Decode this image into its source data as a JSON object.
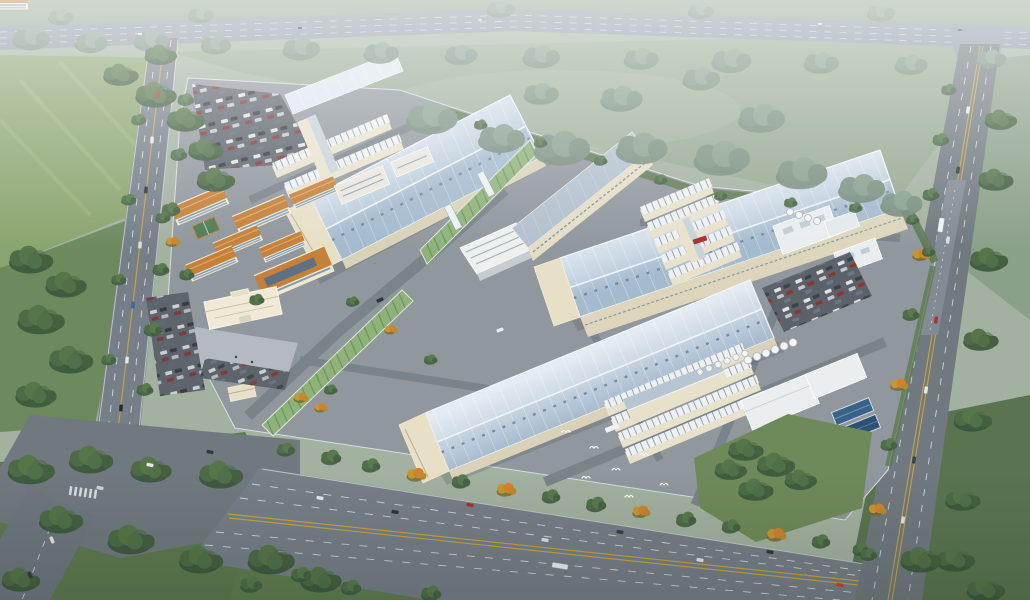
{
  "scene": {
    "title": "Industrial Park Campus — Aerial Rendering",
    "description": "Hazy bird's-eye photorealistic rendering of a large industrial park: three large blue-grey ridged factory halls with cream entrance annexes, clusters of white workshop rows, terracotta-roofed dormitory blocks with a canteen and basketball court, an administration building with forecourt plaza and gatehouse, a utility plant with silos and blue water basins, car parks full of vehicles, tree-lined perimeter roads, green fields and forest belts, and birds flying near the south boulevard.",
    "style": "photorealistic 3D render, hazy daylight, elevated oblique view",
    "counts": {
      "large_factory_halls": 3,
      "small_roof_hall": 1,
      "dormitory_blocks": 6,
      "canteen": 1,
      "office_building": 1,
      "midrise_building": 1,
      "admin_building": 1,
      "workshop_row_clusters": 3,
      "conveyor_galleries": 2,
      "overpass_bridges": 2,
      "utility_plant_blocks": 3,
      "water_basins": 2,
      "silos": 14,
      "parking_lots": 3,
      "gatehouse": 1,
      "billboard": 1,
      "basketball_court": 1,
      "birds": 7
    },
    "roads": [
      "north highway",
      "west avenue",
      "south boulevard",
      "east road",
      "southwest road"
    ],
    "landscape": [
      "forest belts",
      "hazy green fields",
      "mown bright field",
      "campus lawns",
      "autumn trees"
    ]
  },
  "palette": {
    "haze": "#ffffff",
    "field_hazy": "#96a992",
    "field_bright": "#8aa46f",
    "grass_dark": "#5e7a50",
    "lawn": "#6f8a5a",
    "tree_green": "#4e6e48",
    "tree_hazy": "#7d9383",
    "tree_autumn": "#c9962f",
    "highway": "#8c98a2",
    "road": "#767f88",
    "intersection": "#70797f",
    "road_marking_white": "#eef2f5",
    "road_marking_yellow": "#cfa83d",
    "campus_ground": "#90979d",
    "factory_roof_light": "#dde7f0",
    "factory_roof_dark": "#a8bdd0",
    "factory_wall": "#e7e0c6",
    "factory_wall_shade": "#d9d2b9",
    "dorm_wall": "#f1e8d0",
    "dorm_roof": "#c5803a",
    "window_band": "#7c99b5",
    "green_glass": "#8fb27b",
    "office_white": "#edf0ee",
    "midrise_roof": "#b2c0cd",
    "container_white": "#eef1f3",
    "parking_asphalt": "#5b6269",
    "plaza": "#b5bac0",
    "admin_wall": "#efe9d6",
    "basin_blue": "#38628a",
    "billboard_red": "#b43228",
    "court_green": "#4f7d52",
    "car_colors": [
      "#e8eaec",
      "#2c3238",
      "#8a2f2a",
      "#5d6a77",
      "#3d66a8"
    ]
  }
}
